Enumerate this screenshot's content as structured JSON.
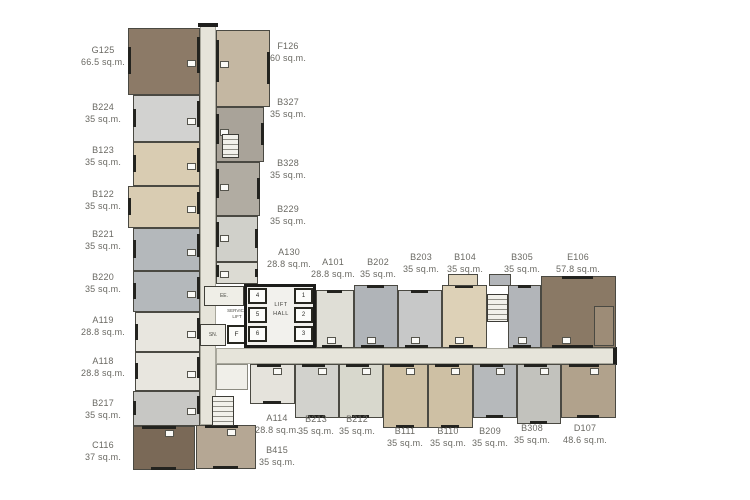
{
  "core": {
    "lift_hall": [
      "LIFT",
      "HALL"
    ],
    "service_lift": [
      "SERVICE",
      "LIFT"
    ],
    "lifts_right": [
      "1",
      "2",
      "3"
    ],
    "lifts_left": [
      "4",
      "5",
      "6"
    ],
    "fire_lift_label": "F",
    "rooms": {
      "ee": "EE.",
      "sn": "SN."
    }
  },
  "colors": {
    "background": "#ffffff",
    "wall": "#23231f",
    "corridor": "#e6e4da",
    "core_fill": "#f2f1ed",
    "label_text": "#6a6963"
  },
  "floorplan": {
    "units": [
      {
        "id": "G125",
        "area": "66.5 sq.m.",
        "x": 128,
        "y": 28,
        "w": 72,
        "h": 67,
        "color": "#8c7a67",
        "face": "R",
        "lx": 103,
        "ly": 56
      },
      {
        "id": "B224",
        "area": "35 sq.m.",
        "x": 133,
        "y": 95,
        "w": 67,
        "h": 47,
        "color": "#d2d2d0",
        "face": "R",
        "lx": 103,
        "ly": 113
      },
      {
        "id": "B123",
        "area": "35 sq.m.",
        "x": 133,
        "y": 142,
        "w": 67,
        "h": 44,
        "color": "#d9ccb2",
        "face": "R",
        "lx": 103,
        "ly": 156
      },
      {
        "id": "B122",
        "area": "35 sq.m.",
        "x": 128,
        "y": 186,
        "w": 72,
        "h": 42,
        "color": "#d9ccb2",
        "face": "R",
        "lx": 103,
        "ly": 200
      },
      {
        "id": "B221",
        "area": "35 sq.m.",
        "x": 133,
        "y": 228,
        "w": 67,
        "h": 43,
        "color": "#b4b8bb",
        "face": "R",
        "lx": 103,
        "ly": 240
      },
      {
        "id": "B220",
        "area": "35 sq.m.",
        "x": 133,
        "y": 271,
        "w": 67,
        "h": 41,
        "color": "#b4b8bb",
        "face": "R",
        "lx": 103,
        "ly": 283
      },
      {
        "id": "A119",
        "area": "28.8 sq.m.",
        "x": 135,
        "y": 312,
        "w": 65,
        "h": 40,
        "color": "#e8e6df",
        "face": "R",
        "lx": 103,
        "ly": 326
      },
      {
        "id": "A118",
        "area": "28.8 sq.m.",
        "x": 135,
        "y": 352,
        "w": 65,
        "h": 39,
        "color": "#e8e6df",
        "face": "R",
        "lx": 103,
        "ly": 367
      },
      {
        "id": "B217",
        "area": "35 sq.m.",
        "x": 133,
        "y": 391,
        "w": 67,
        "h": 35,
        "color": "#c7c7c4",
        "face": "R",
        "lx": 103,
        "ly": 409
      },
      {
        "id": "C116",
        "area": "37 sq.m.",
        "x": 133,
        "y": 426,
        "w": 62,
        "h": 44,
        "color": "#7a6957",
        "face": "T",
        "lx": 103,
        "ly": 451
      },
      {
        "id": "F126",
        "area": "60 sq.m.",
        "x": 216,
        "y": 30,
        "w": 54,
        "h": 77,
        "color": "#c4b7a2",
        "face": "L",
        "lx": 288,
        "ly": 52
      },
      {
        "id": "B327",
        "area": "35 sq.m.",
        "x": 216,
        "y": 107,
        "w": 48,
        "h": 55,
        "color": "#a9a399",
        "face": "L",
        "lx": 288,
        "ly": 108
      },
      {
        "id": "B328",
        "area": "35 sq.m.",
        "x": 216,
        "y": 162,
        "w": 44,
        "h": 54,
        "color": "#b1aca2",
        "face": "L",
        "lx": 288,
        "ly": 169
      },
      {
        "id": "B229",
        "area": "35 sq.m.",
        "x": 216,
        "y": 216,
        "w": 42,
        "h": 46,
        "color": "#d0d0ca",
        "face": "L",
        "lx": 288,
        "ly": 215
      },
      {
        "id": "A130",
        "area": "28.8 sq.m.",
        "x": 216,
        "y": 262,
        "w": 42,
        "h": 22,
        "color": "#dcdbd3",
        "face": "L",
        "lx": 289,
        "ly": 258
      },
      {
        "id": "B415",
        "area": "35 sq.m.",
        "x": 196,
        "y": 425,
        "w": 60,
        "h": 44,
        "color": "#b5a794",
        "face": "T",
        "lx": 277,
        "ly": 456
      },
      {
        "id": "A101",
        "area": "28.8 sq.m.",
        "x": 316,
        "y": 290,
        "w": 38,
        "h": 58,
        "color": "#dfded6",
        "face": "B",
        "lx": 333,
        "ly": 268
      },
      {
        "id": "B202",
        "area": "35 sq.m.",
        "x": 354,
        "y": 285,
        "w": 44,
        "h": 63,
        "color": "#b0b4b8",
        "face": "B",
        "lx": 378,
        "ly": 268
      },
      {
        "id": "B203",
        "area": "35 sq.m.",
        "x": 398,
        "y": 290,
        "w": 44,
        "h": 58,
        "color": "#c7c8c8",
        "face": "B",
        "lx": 421,
        "ly": 263
      },
      {
        "id": "B104",
        "area": "35 sq.m.",
        "x": 442,
        "y": 285,
        "w": 45,
        "h": 63,
        "color": "#ddd1b7",
        "face": "B",
        "lx": 465,
        "ly": 263
      },
      {
        "id": "B305",
        "area": "35 sq.m.",
        "x": 508,
        "y": 285,
        "w": 33,
        "h": 63,
        "color": "#b2b5b9",
        "face": "B",
        "lx": 522,
        "ly": 263
      },
      {
        "id": "E106",
        "area": "57.8 sq.m.",
        "x": 541,
        "y": 276,
        "w": 75,
        "h": 72,
        "color": "#8a7965",
        "face": "B",
        "lx": 578,
        "ly": 263
      },
      {
        "id": "A114",
        "area": "28.8 sq.m.",
        "x": 250,
        "y": 364,
        "w": 45,
        "h": 40,
        "color": "#e5e3dc",
        "face": "T",
        "lx": 277,
        "ly": 424
      },
      {
        "id": "B213",
        "area": "35 sq.m.",
        "x": 295,
        "y": 364,
        "w": 44,
        "h": 54,
        "color": "#d2d2cd",
        "face": "T",
        "lx": 316,
        "ly": 425
      },
      {
        "id": "B212",
        "area": "35 sq.m.",
        "x": 339,
        "y": 364,
        "w": 44,
        "h": 54,
        "color": "#d8d8cd",
        "face": "T",
        "lx": 357,
        "ly": 425
      },
      {
        "id": "B111",
        "area": "35 sq.m.",
        "x": 383,
        "y": 364,
        "w": 45,
        "h": 64,
        "color": "#cec0a4",
        "face": "T",
        "lx": 405,
        "ly": 437
      },
      {
        "id": "B110",
        "area": "35 sq.m.",
        "x": 428,
        "y": 364,
        "w": 45,
        "h": 64,
        "color": "#cec0a4",
        "face": "T",
        "lx": 448,
        "ly": 437
      },
      {
        "id": "B209",
        "area": "35 sq.m.",
        "x": 473,
        "y": 364,
        "w": 44,
        "h": 54,
        "color": "#b6b9bb",
        "face": "T",
        "lx": 490,
        "ly": 437
      },
      {
        "id": "B308",
        "area": "35 sq.m.",
        "x": 517,
        "y": 364,
        "w": 44,
        "h": 60,
        "color": "#c2c2bd",
        "face": "T",
        "lx": 532,
        "ly": 434
      },
      {
        "id": "D107",
        "area": "48.6 sq.m.",
        "x": 561,
        "y": 364,
        "w": 55,
        "h": 54,
        "color": "#b1a28c",
        "face": "T",
        "lx": 585,
        "ly": 434
      }
    ]
  }
}
